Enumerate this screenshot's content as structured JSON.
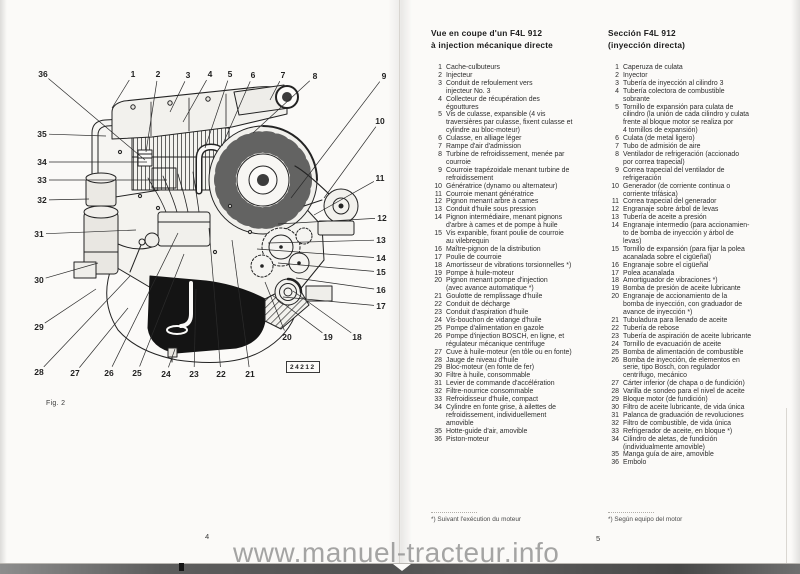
{
  "watermark": "www.manuel-tracteur.info",
  "left_page": {
    "fig_label": "Fig. 2",
    "plate_number": "24212",
    "page_number": "4",
    "callouts": [
      {
        "n": "1",
        "x": 133,
        "y": 74,
        "tx": 112,
        "ty": 108
      },
      {
        "n": "2",
        "x": 158,
        "y": 74,
        "tx": 146,
        "ty": 152
      },
      {
        "n": "3",
        "x": 188,
        "y": 75,
        "tx": 170,
        "ty": 112
      },
      {
        "n": "4",
        "x": 210,
        "y": 74,
        "tx": 183,
        "ty": 122
      },
      {
        "n": "5",
        "x": 230,
        "y": 74,
        "tx": 205,
        "ty": 148
      },
      {
        "n": "6",
        "x": 253,
        "y": 75,
        "tx": 222,
        "ty": 146
      },
      {
        "n": "7",
        "x": 283,
        "y": 75,
        "tx": 270,
        "ty": 100
      },
      {
        "n": "8",
        "x": 315,
        "y": 76,
        "tx": 253,
        "ty": 133
      },
      {
        "n": "9",
        "x": 384,
        "y": 76,
        "tx": 291,
        "ty": 198
      },
      {
        "n": "10",
        "x": 380,
        "y": 121,
        "tx": 324,
        "ty": 198
      },
      {
        "n": "11",
        "x": 380,
        "y": 178,
        "tx": 314,
        "ty": 215
      },
      {
        "n": "12",
        "x": 382,
        "y": 218,
        "tx": 278,
        "ty": 224
      },
      {
        "n": "13",
        "x": 381,
        "y": 240,
        "tx": 268,
        "ty": 243
      },
      {
        "n": "14",
        "x": 381,
        "y": 258,
        "tx": 257,
        "ty": 249
      },
      {
        "n": "15",
        "x": 381,
        "y": 272,
        "tx": 278,
        "ty": 263
      },
      {
        "n": "16",
        "x": 381,
        "y": 290,
        "tx": 296,
        "ty": 278
      },
      {
        "n": "17",
        "x": 381,
        "y": 306,
        "tx": 283,
        "ty": 297
      },
      {
        "n": "18",
        "x": 357,
        "y": 337,
        "tx": 293,
        "ty": 291
      },
      {
        "n": "19",
        "x": 328,
        "y": 337,
        "tx": 272,
        "ty": 295
      },
      {
        "n": "20",
        "x": 287,
        "y": 337,
        "tx": 265,
        "ty": 282
      },
      {
        "n": "21",
        "x": 250,
        "y": 374,
        "tx": 232,
        "ty": 240
      },
      {
        "n": "22",
        "x": 221,
        "y": 374,
        "tx": 209,
        "ty": 228
      },
      {
        "n": "23",
        "x": 194,
        "y": 374,
        "tx": 196,
        "ty": 289
      },
      {
        "n": "24",
        "x": 166,
        "y": 374,
        "tx": 175,
        "ty": 349
      },
      {
        "n": "25",
        "x": 137,
        "y": 373,
        "tx": 184,
        "ty": 254
      },
      {
        "n": "26",
        "x": 109,
        "y": 373,
        "tx": 178,
        "ty": 233
      },
      {
        "n": "27",
        "x": 75,
        "y": 373,
        "tx": 128,
        "ty": 308
      },
      {
        "n": "28",
        "x": 39,
        "y": 372,
        "tx": 130,
        "ty": 276
      },
      {
        "n": "29",
        "x": 39,
        "y": 327,
        "tx": 96,
        "ty": 289
      },
      {
        "n": "30",
        "x": 39,
        "y": 280,
        "tx": 98,
        "ty": 263
      },
      {
        "n": "31",
        "x": 39,
        "y": 234,
        "tx": 136,
        "ty": 230
      },
      {
        "n": "32",
        "x": 42,
        "y": 200,
        "tx": 89,
        "ty": 199
      },
      {
        "n": "33",
        "x": 42,
        "y": 180,
        "tx": 167,
        "ty": 180
      },
      {
        "n": "34",
        "x": 42,
        "y": 162,
        "tx": 147,
        "ty": 162
      },
      {
        "n": "35",
        "x": 42,
        "y": 134,
        "tx": 106,
        "ty": 136
      },
      {
        "n": "36",
        "x": 43,
        "y": 74,
        "tx": 145,
        "ty": 160
      }
    ]
  },
  "right_page": {
    "page_number": "5",
    "french": {
      "title_line1": "Vue en coupe d'un F4L 912",
      "title_line2": "à injection mécanique directe",
      "footnote": "*) Suivant l'exécution du moteur",
      "items": [
        {
          "n": "1",
          "text": "Cache-culbuteurs"
        },
        {
          "n": "2",
          "text": "Injecteur"
        },
        {
          "n": "3",
          "text": "Conduit de refoulement vers\ninjecteur No. 3"
        },
        {
          "n": "4",
          "text": "Collecteur de récupération des\négouttures"
        },
        {
          "n": "5",
          "text": "Vis de culasse, expansible (4 vis\ntraversières par culasse, fixent culasse et\ncylindre au bloc-moteur)"
        },
        {
          "n": "6",
          "text": "Culasse, en alliage léger"
        },
        {
          "n": "7",
          "text": "Rampe d'air d'admission"
        },
        {
          "n": "8",
          "text": "Turbine de refroidissement, menée par\ncourroie"
        },
        {
          "n": "9",
          "text": "Courroie trapézoidale menant turbine de\nrefroidissement"
        },
        {
          "n": "10",
          "text": "Génératrice (dynamo ou alternateur)"
        },
        {
          "n": "11",
          "text": "Courroie menant génératrice"
        },
        {
          "n": "12",
          "text": "Pignon menant arbre à cames"
        },
        {
          "n": "13",
          "text": "Conduit d'huile sous pression"
        },
        {
          "n": "14",
          "text": "Pignon intermédiaire, menant pignons\nd'arbre à cames et de pompe à huile"
        },
        {
          "n": "15",
          "text": "Vis expanible, fixant poulie de courroie\nau vilebrequin"
        },
        {
          "n": "16",
          "text": "Maître-pignon de la distribution"
        },
        {
          "n": "17",
          "text": "Poulie de courroie"
        },
        {
          "n": "18",
          "text": "Amortisseur de vibrations torsionnelles *)"
        },
        {
          "n": "19",
          "text": "Pompe à huile-moteur"
        },
        {
          "n": "20",
          "text": "Pignon menant pompe d'injection\n(avec avance automatique *)"
        },
        {
          "n": "21",
          "text": "Goulotte de remplissage d'huile"
        },
        {
          "n": "22",
          "text": "Conduit de décharge"
        },
        {
          "n": "23",
          "text": "Conduit d'aspiration d'huile"
        },
        {
          "n": "24",
          "text": "Vis-bouchon de vidange d'huile"
        },
        {
          "n": "25",
          "text": "Pompe d'alimentation en gazole"
        },
        {
          "n": "26",
          "text": "Pompe d'injection BOSCH, en ligne, et\nrégulateur mécanique centrifuge"
        },
        {
          "n": "27",
          "text": "Cuve à huile-moteur (en tôle ou en fonte)"
        },
        {
          "n": "28",
          "text": "Jauge de niveau d'huile"
        },
        {
          "n": "29",
          "text": "Bloc-moteur (en fonte de fer)"
        },
        {
          "n": "30",
          "text": "Filtre à huile, consommable"
        },
        {
          "n": "31",
          "text": "Levier de commande d'accélération"
        },
        {
          "n": "32",
          "text": "Filtre-nourrice consommable"
        },
        {
          "n": "33",
          "text": "Refroidisseur d'huile, compact"
        },
        {
          "n": "34",
          "text": "Cylindre en fonte grise, à ailettes de\nrefroidissement, individuellement\namovible"
        },
        {
          "n": "35",
          "text": "Hotte-guide d'air, amovible"
        },
        {
          "n": "36",
          "text": "Piston-moteur"
        }
      ]
    },
    "spanish": {
      "title_line1": "Sección F4L 912",
      "title_line2": "(inyección directa)",
      "footnote": "*) Según equipo del motor",
      "items": [
        {
          "n": "1",
          "text": "Caperuza de culata"
        },
        {
          "n": "2",
          "text": "Inyector"
        },
        {
          "n": "3",
          "text": "Tubería de inyección al cilindro 3"
        },
        {
          "n": "4",
          "text": "Tubería colectora de combustible\nsobrante"
        },
        {
          "n": "5",
          "text": "Tornillo de expansión para culata de\ncilindro (la unión de cada cilindro y culata\nfrente al bloque motor se realiza por\n4 tornillos de expansión)"
        },
        {
          "n": "6",
          "text": "Culata (de metal ligero)"
        },
        {
          "n": "7",
          "text": "Tubo de admisión de aire"
        },
        {
          "n": "8",
          "text": "Ventilador de refrigeración (accionado\npor correa trapecial)"
        },
        {
          "n": "9",
          "text": "Correa trapecial del ventilador de\nrefrigeración"
        },
        {
          "n": "10",
          "text": "Generador (de corriente continua o\ncorriente trifásica)"
        },
        {
          "n": "11",
          "text": "Correa trapecial del generador"
        },
        {
          "n": "12",
          "text": "Engranaje sobre árbol de levas"
        },
        {
          "n": "13",
          "text": "Tubería de aceite a presión"
        },
        {
          "n": "14",
          "text": "Engranaje intermedio (para accionamien-\nto de bomba de inyección y árbol de\nlevas)"
        },
        {
          "n": "15",
          "text": "Tornillo de expansión (para fijar la polea\nacanalada sobre el cigüeñal)"
        },
        {
          "n": "16",
          "text": "Engranaje sobre el cigüeñal"
        },
        {
          "n": "17",
          "text": "Polea acanalada"
        },
        {
          "n": "18",
          "text": "Amortiguador de vibraciones *)"
        },
        {
          "n": "19",
          "text": "Bomba de presión de aceite lubricante"
        },
        {
          "n": "20",
          "text": "Engranaje de accionamiento de la\nbomba de inyección, con graduador de\navance de inyección *)"
        },
        {
          "n": "21",
          "text": "Tubuladura para llenado de aceite"
        },
        {
          "n": "22",
          "text": "Tubería de rebose"
        },
        {
          "n": "23",
          "text": "Tubería de aspiración de aceite lubricante"
        },
        {
          "n": "24",
          "text": "Tornillo de evacuación de aceite"
        },
        {
          "n": "25",
          "text": "Bomba de alimentación de combustible"
        },
        {
          "n": "26",
          "text": "Bomba de inyección, de elementos en\nserie, tipo Bosch, con regulador\ncentrífugo, mecánico"
        },
        {
          "n": "27",
          "text": "Cárter inferior (de chapa o de fundición)"
        },
        {
          "n": "28",
          "text": "Varilla de sondeo para el nivel de aceite"
        },
        {
          "n": "29",
          "text": "Bloque motor (de fundición)"
        },
        {
          "n": "30",
          "text": "Filtro de aceite lubricante, de vida única"
        },
        {
          "n": "31",
          "text": "Palanca de graduación de revoluciones"
        },
        {
          "n": "32",
          "text": "Filtro de combustible, de vida única"
        },
        {
          "n": "33",
          "text": "Refrigerador de aceite, en bloque *)"
        },
        {
          "n": "34",
          "text": "Cilindro de aletas, de fundición\n(individualmente amovible)"
        },
        {
          "n": "35",
          "text": "Manga guía de aire, amovible"
        },
        {
          "n": "36",
          "text": "Embolo"
        }
      ]
    }
  }
}
